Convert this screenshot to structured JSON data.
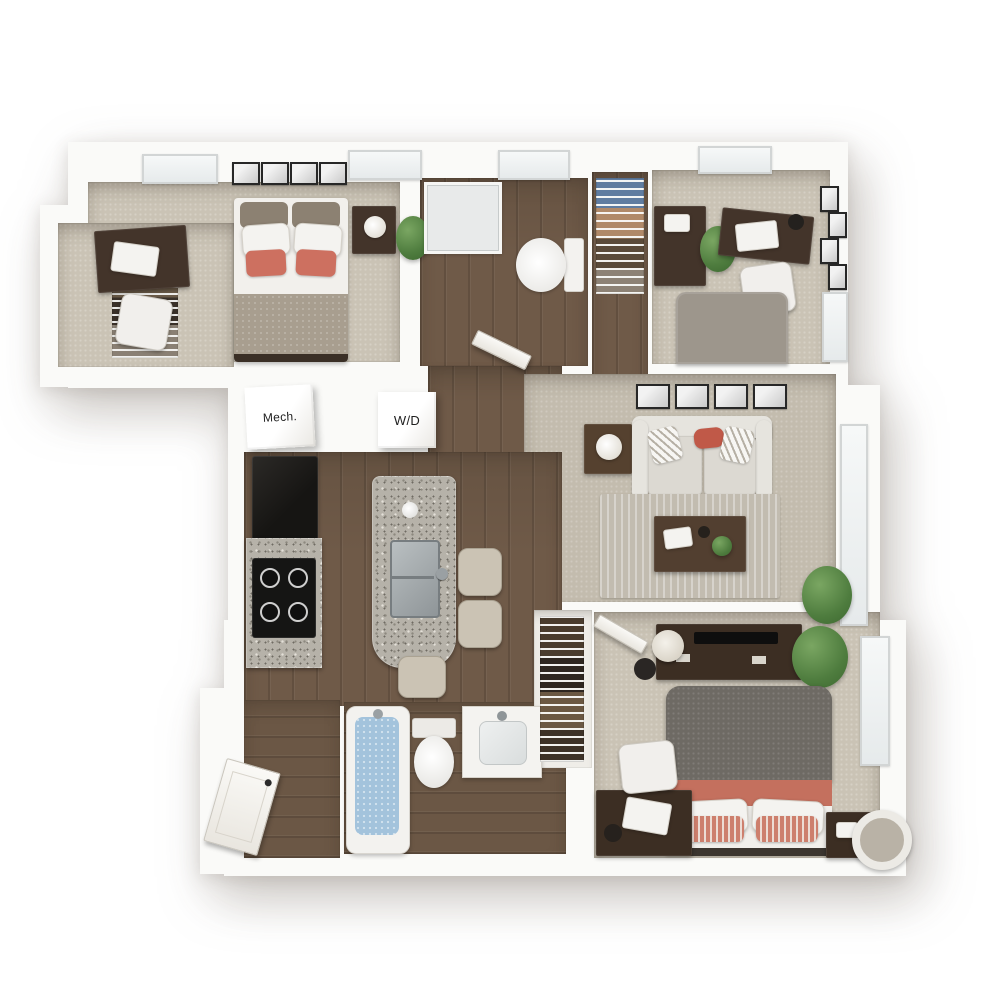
{
  "scene": {
    "type": "3d-floor-plan",
    "description": "Top-down 3D rendering of a furnished apartment floor plan with three bedrooms, two bathrooms, kitchen with island, living room, mechanical room and washer/dryer closet",
    "background": "#ffffff"
  },
  "labels": {
    "mech": "Mech.",
    "washer_dryer": "W/D"
  },
  "palette": {
    "wall": "#fafaf8",
    "carpet": "#cac3b5",
    "wood_floor": "#6f5a48",
    "granite": "#b6b2a9",
    "dark_wood_furniture": "#43342a",
    "sofa_gray": "#dedbd4",
    "accent_coral": "#cd7060",
    "bed_gray": "#9d968c",
    "duvet_charcoal": "#6e6a64",
    "plant_green": "#4e7c3e",
    "tub_water": "#a3c3dc",
    "appliance_black": "#1b1a18"
  },
  "rooms": [
    {
      "id": "bedroom-1",
      "name": "Bedroom 1 (top left)",
      "floor": "carpet",
      "contents": [
        "desk with laptop",
        "office chair",
        "bed with coral pillows",
        "nightstand with lamp",
        "potted plant",
        "four framed prints",
        "two windows",
        "walk-in closet with wire shelving"
      ]
    },
    {
      "id": "bathroom-1",
      "name": "Bathroom 1 (top middle)",
      "floor": "wood",
      "contents": [
        "shower",
        "toilet",
        "window",
        "door to hall"
      ]
    },
    {
      "id": "coat-closet",
      "name": "Hall closet",
      "floor": "wood",
      "contents": [
        "wire shelving",
        "hanging clothes"
      ]
    },
    {
      "id": "bedroom-2",
      "name": "Bedroom 2 (top right)",
      "floor": "carpet",
      "contents": [
        "dresser",
        "desk with laptop and lamp",
        "office chair",
        "gray bed",
        "potted plant",
        "framed prints",
        "window top",
        "window right"
      ]
    },
    {
      "id": "living-room",
      "name": "Living room",
      "floor": "carpet",
      "contents": [
        "sofa with striped and coral pillows",
        "side table with lamp",
        "area rug",
        "coffee table with books and plant",
        "floor plant",
        "four framed prints",
        "window"
      ]
    },
    {
      "id": "kitchen",
      "name": "Kitchen",
      "floor": "wood",
      "contents": [
        "refrigerator",
        "granite counter",
        "range cooktop",
        "island with sink and faucet",
        "three bar stools"
      ]
    },
    {
      "id": "mech-room",
      "name": "Mechanical room",
      "label": "Mech."
    },
    {
      "id": "laundry-closet",
      "name": "Washer/dryer closet",
      "label": "W/D"
    },
    {
      "id": "bathroom-2",
      "name": "Bathroom 2 (bottom)",
      "floor": "wood",
      "contents": [
        "bathtub filled with water",
        "toilet",
        "vanity sink"
      ]
    },
    {
      "id": "bedroom-3",
      "name": "Bedroom 3 (bottom right)",
      "floor": "carpet",
      "contents": [
        "media console with TV",
        "drum lamp",
        "speaker",
        "potted plant",
        "bed with charcoal duvet and coral throw",
        "striped pillows",
        "desk with laptop",
        "office chair",
        "nightstand",
        "round hamper",
        "closet with hanging clothes",
        "window",
        "door"
      ]
    },
    {
      "id": "entry",
      "name": "Entry corridor",
      "floor": "wood",
      "contents": [
        "entry door"
      ]
    }
  ]
}
